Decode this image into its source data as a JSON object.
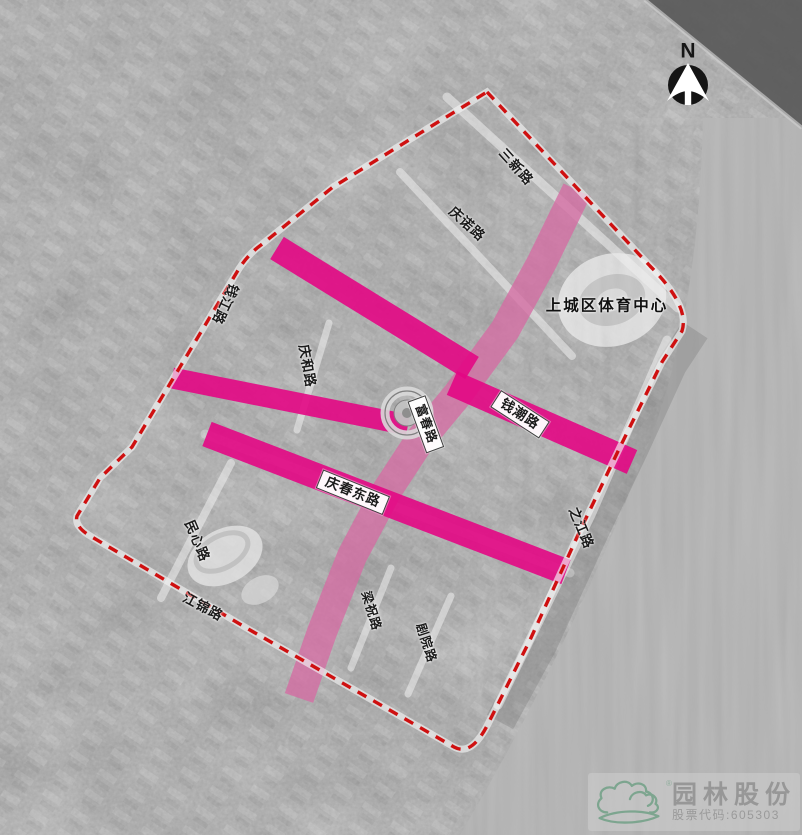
{
  "map": {
    "type": "annotated-aerial-plan",
    "landmarks": {
      "sports_center": "上城区体育中心"
    },
    "road_labels": {
      "sanxin": "三新路",
      "qingnuo": "庆诺路",
      "qianjiang": "钱江路",
      "qinghe": "庆和路",
      "qianchao": "钱潮路",
      "fuchun": "富春路",
      "qingchundong": "庆春东路",
      "minxin": "民心路",
      "jiangjin": "江锦路",
      "liangzhu": "梁祝路",
      "juyuan": "剧院路",
      "zhijiang": "之江路"
    },
    "north_indicator": {
      "label": "N"
    },
    "colors": {
      "boundary_red": "#cf1010",
      "highlight_magenta": "#e30784",
      "highlight_magenta_light": "#d56ca3",
      "logo_green": "#7da58f",
      "logo_text_gray": "#979797"
    }
  },
  "logo": {
    "company": "园林股份",
    "stock_label": "股票代码:605303",
    "registered": "®"
  }
}
